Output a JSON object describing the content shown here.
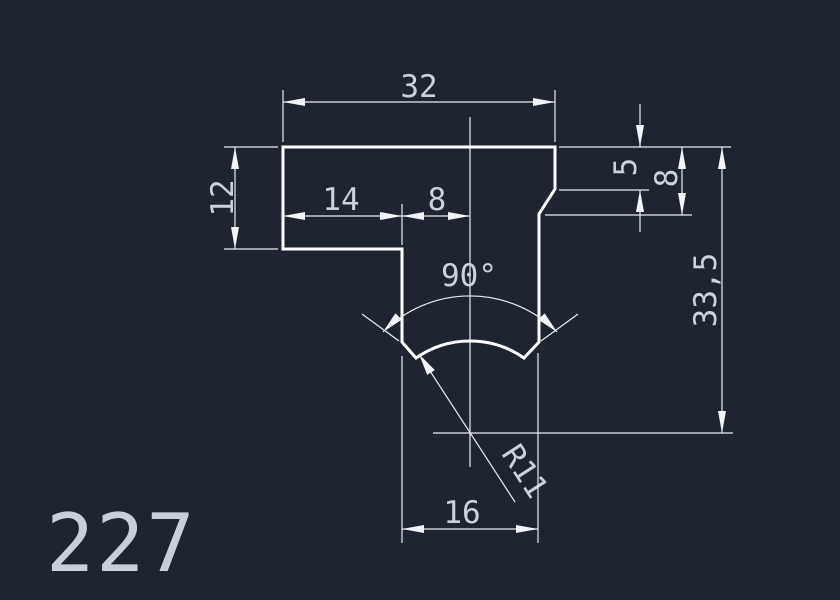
{
  "drawing": {
    "number": "227",
    "dimensions": {
      "top_width": "32",
      "flange_thickness": "12",
      "left_flange_length": "14",
      "center_offset": "8",
      "right_step_height": "5",
      "right_shoulder_height": "8",
      "total_height": "33,5",
      "notch_angle": "90°",
      "notch_radius": "R11",
      "stem_width": "16"
    },
    "colors": {
      "background": "#1f2530",
      "geometry_line": "#ffffff",
      "dimension_line": "#e9ecf2",
      "dimension_text": "#ccd2dc"
    }
  }
}
